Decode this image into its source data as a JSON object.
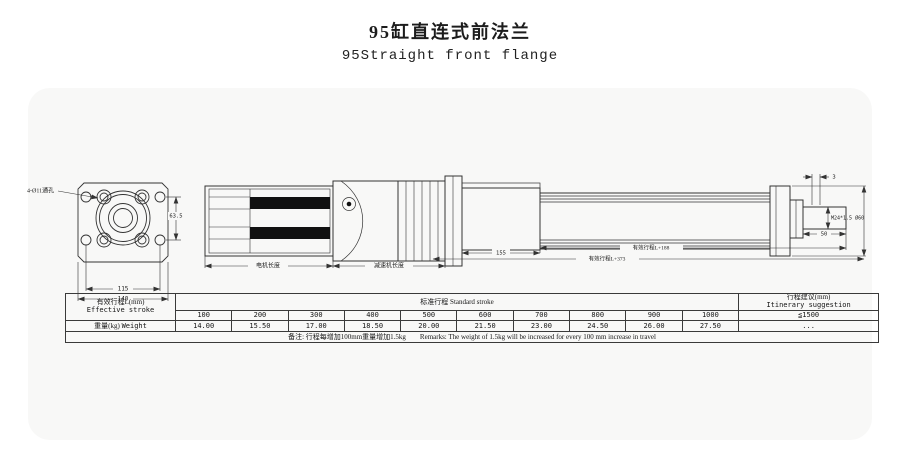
{
  "title": {
    "zh": "95缸直连式前法兰",
    "en": "95Straight front flange"
  },
  "drawing": {
    "front_view": {
      "holes_label": "4-Ø11通孔",
      "dim_hole_spacing": "115",
      "dim_width": "140",
      "dim_height": "63.5"
    },
    "side_view": {
      "motor_length_label": "电机长度",
      "reducer_length_label": "减速机长度",
      "head_length_dim": "155",
      "stroke_dim_upper": "有效行程L+188",
      "stroke_dim_lower": "有效行程L+373",
      "rod_tip_dim": "3",
      "rod_thread_label": "M24*1.5 Ø60",
      "rod_length_dim": "50"
    }
  },
  "table": {
    "effective_stroke_zh": "有效行程L(mm)",
    "effective_stroke_en": "Effective stroke",
    "standard_stroke_label": "标准行程  Standard stroke",
    "suggestion_zh": "行程建议(mm)",
    "suggestion_en": "Itinerary suggestion",
    "suggestion_value": "≦1500",
    "suggestion_weight": "...",
    "weight_zh": "重量(kg)",
    "weight_en": "Weight",
    "strokes": [
      "100",
      "200",
      "300",
      "400",
      "500",
      "600",
      "700",
      "800",
      "900",
      "1000"
    ],
    "weights": [
      "14.00",
      "15.50",
      "17.00",
      "18.50",
      "20.00",
      "21.50",
      "23.00",
      "24.50",
      "26.00",
      "27.50"
    ],
    "remarks": "备注: 行程每增加100mm重量增加1.5kg　　Remarks: The weight of 1.5kg will be increased for every 100 mm increase in travel"
  }
}
